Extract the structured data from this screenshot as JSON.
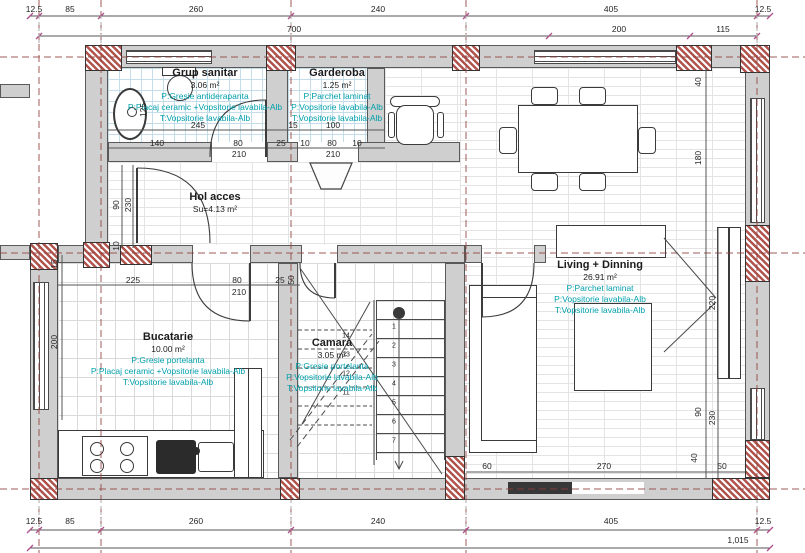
{
  "title": "Plan parter - locuinta",
  "colors": {
    "wall_fill": "#cfcfcf",
    "masonry_hatch": "#b2544e",
    "axis_line": "#8f3f3b",
    "finish_text": "#00a0ac",
    "dim_text": "#262626",
    "tile_bath": "#c4dde9",
    "tile_gray": "#dadada",
    "tick_magenta": "#b0518c"
  },
  "rooms": [
    {
      "name": "Grup sanitar",
      "area": "3.06 m²",
      "finishes": [
        "P:Gresie antiderapanta",
        "P:Placaj ceramic +Vopsitorie lavabila-Alb",
        "T:Vopsitorie lavabila-Alb"
      ]
    },
    {
      "name": "Garderoba",
      "area": "1.25 m²",
      "finishes": [
        "P:Parchet laminat",
        "P:Vopsitorie lavabila-Alb",
        "T:Vopsitorie lavabila-Alb"
      ]
    },
    {
      "name": "Hol acces",
      "area": "Su=4.13 m²",
      "finishes": []
    },
    {
      "name": "Bucatarie",
      "area": "10.00 m²",
      "finishes": [
        "P:Gresie portelanta",
        "P:Placaj ceramic +Vopsitorie lavabila-Alb",
        "T:Vopsitorie lavabila-Alb"
      ]
    },
    {
      "name": "Camara",
      "area": "3.05 m²",
      "finishes": [
        "P:Gresie portelanta",
        "P:Vopsitorie lavabila-Alb",
        "T:Vopsitorie lavabila-Alb"
      ]
    },
    {
      "name": "Living + Dinning",
      "area": "26.91 m²",
      "finishes": [
        "P:Parchet laminat",
        "P:Vopsitorie lavabila-Alb",
        "T:Vopsitorie lavabila-Alb"
      ]
    }
  ],
  "dims": {
    "top1": [
      "12.5",
      "85",
      "260",
      "240",
      "405",
      "12.5"
    ],
    "top2": [
      "700",
      "200",
      "115"
    ],
    "bot1": [
      "12.5",
      "85",
      "260",
      "240",
      "405",
      "12.5"
    ],
    "total": "1,015",
    "bath": {
      "w": "245",
      "segs": [
        "140",
        "80",
        "25"
      ],
      "door": "210",
      "h": "125"
    },
    "gard": {
      "lead": "15",
      "w": "100",
      "segs": [
        "10",
        "80",
        "10"
      ],
      "door": "210"
    },
    "hol": [
      "90",
      "230",
      "10"
    ],
    "kitchen": {
      "left": [
        "15",
        "200"
      ],
      "top": [
        "225",
        "80",
        "25"
      ],
      "door": "210",
      "right": "50"
    },
    "right": [
      "40",
      "180",
      "220",
      "90",
      "230",
      "40"
    ],
    "living_bottom": [
      "60",
      "270",
      "50"
    ]
  },
  "stairs": {
    "right": [
      "1",
      "2",
      "3",
      "4",
      "5",
      "6",
      "7"
    ],
    "left": [
      "14",
      "13",
      "12",
      "11"
    ]
  }
}
